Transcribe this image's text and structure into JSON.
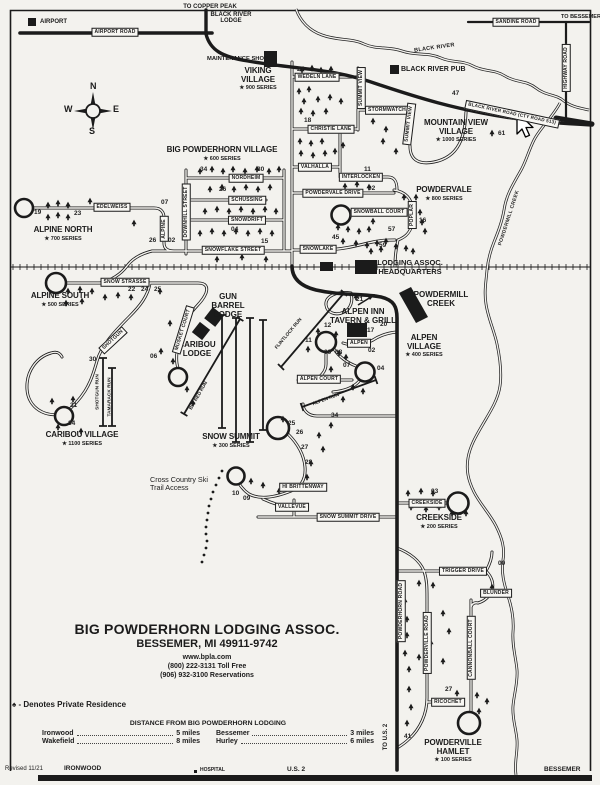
{
  "map": {
    "edges": {
      "to_copper_peak": "TO COPPER PEAK",
      "to_bessemer": "TO BESSEMER",
      "to_us2": "TO U.S. 2",
      "ironwood": "IRONWOOD",
      "hospital": "HOSPITAL",
      "us2": "U.S. 2",
      "bessemer": "BESSEMER",
      "revised": "Revised 11/21"
    },
    "compass": {
      "n": "N",
      "e": "E",
      "s": "S",
      "w": "W"
    },
    "waterways": {
      "black_river": "BLACK RIVER",
      "powdermill_creek": "POWDERMILL CREEK"
    },
    "pois": {
      "airport": "AIRPORT",
      "black_river_lodge": "BLACK RIVER LODGE",
      "maintenance_shop": "MAINTENANCE SHOP",
      "black_river_pub": "BLACK RIVER PUB",
      "lodging_hq": "LODGING ASSOC. HEADQUARTERS",
      "powdermill_creek": "POWDERMILL CREEK",
      "gun_barrel_lodge": "GUN BARREL LODGE",
      "caribou_lodge": "CARIBOU LODGE",
      "alpen_inn": "ALPEN INN TAVERN & GRILL",
      "xc_access": "Cross Country Ski Trail Access"
    },
    "villages": {
      "viking": {
        "name": "VIKING VILLAGE",
        "series": "★ 900 SERIES"
      },
      "mountain_view": {
        "name": "MOUNTAIN VIEW VILLAGE",
        "series": "★ 1000 SERIES"
      },
      "big_powderhorn": {
        "name": "BIG POWDERHORN VILLAGE",
        "series": "★ 600 SERIES"
      },
      "powdervale": {
        "name": "POWDERVALE",
        "series": "★ 800 SERIES"
      },
      "alpine_north": {
        "name": "ALPINE NORTH",
        "series": "★ 700 SERIES"
      },
      "alpine_south": {
        "name": "ALPINE SOUTH",
        "series": "★ 500 SERIES"
      },
      "alpen": {
        "name": "ALPEN VILLAGE",
        "series": "★ 400 SERIES"
      },
      "snow_summit": {
        "name": "SNOW SUMMIT",
        "series": "★ 300 SERIES"
      },
      "caribou": {
        "name": "CARIBOU VILLAGE",
        "series": "★ 1100 SERIES"
      },
      "creekside": {
        "name": "CREEKSIDE",
        "series": "★ 200 SERIES"
      },
      "powderville": {
        "name": "POWDERVILLE HAMLET",
        "series": "★ 100 SERIES"
      }
    },
    "roads": {
      "airport_road": "AIRPORT ROAD",
      "sandine_road": "SANDINE ROAD",
      "highway_road": "HIGHWAY ROAD",
      "black_river_road": "BLACK RIVER ROAD (CTY ROAD 513)",
      "wedeln_lane": "WEDELN LANE",
      "summit_view_a": "SUMMIT VIEW",
      "summit_view_b": "SUMMIT VIEW",
      "stormwatch": "STORMWATCH",
      "christie_lane": "CHRISTIE LANE",
      "valhalla": "VALHALLA",
      "interlocken": "INTERLOCKEN",
      "nordheim": "NORDHEIM",
      "schussing": "SCHUSSING",
      "snowdrift": "SNOWDRIFT",
      "snowflake_street": "SNOWFLAKE STREET",
      "downhill_street": "DOWNHILL STREET",
      "alpine": "ALPINE",
      "edelweiss": "EDELWEISS",
      "powdervale_drive": "POWDERVALE DRIVE",
      "snowball_court": "SNOWBALL COURT",
      "poplar": "POPLAR",
      "snowlake": "SNOWLAKE",
      "snow_strasse": "SNOW STRASSE",
      "musket_court": "MUSKET COURT",
      "shotgun": "SHOTGUN",
      "alpen": "ALPEN",
      "alpen_court": "ALPEN COURT",
      "hi_brittenway": "HI BRITTENWAY",
      "vallevue": "VALLEVUE",
      "snow_summit_drive": "SNOW SUMMIT DRIVE",
      "creekside": "CREEKSIDE",
      "trigger_drive": "TRIGGER DRIVE",
      "blunder": "BLUNDER",
      "ricochet": "RICOCHET",
      "powderhorn_road": "POWDERHORN ROAD",
      "powderville_road": "POWDERVILLE ROAD",
      "cannonball_court": "CANNONBALL COURT"
    },
    "runs": {
      "shotgun_run": "SHOTGUN RUN",
      "tamarack_run": "TAMARACK RUN",
      "big_red_run": "BIG RED RUN",
      "flintlock_run": "FLINTLOCK RUN",
      "alpen_run": "ALPEN RUN"
    },
    "lots": {
      "wedeln": "27",
      "christie": "18",
      "interlocken": "11",
      "powdervale_drive": "02",
      "highway": "47",
      "mountain_view": "61",
      "nordheim_w": "34",
      "nordheim_e": "30",
      "schussing": "26",
      "snowdrift": "04",
      "snowflake": "15",
      "alpine_curve": "07",
      "alpine_w": "26",
      "alpine_e": "02",
      "poplar": "16",
      "powdervale_a": "57",
      "powdervale_b": "45",
      "powdervale_c": "59",
      "alpine_north_w": "19",
      "alpine_north_e": "23",
      "snow_strasse_a": "22",
      "snow_strasse_b": "24",
      "snow_strasse_c": "25",
      "hq_ramp": "21",
      "shotgun": "30",
      "musket": "06",
      "caribou_a": "31",
      "caribou_b": "34",
      "alpen_a": "12",
      "alpen_b": "11",
      "alpen_c": "17",
      "alpen_d": "20",
      "alpen_e": "02",
      "alpen_f": "09",
      "alpen_g": "08",
      "alpen_h": "07",
      "alpen_i": "04",
      "road34": "34",
      "summit_a": "25",
      "summit_b": "26",
      "summit_c": "27",
      "summit_d": "28",
      "summit_e": "10",
      "summit_f": "09",
      "creekside": "03",
      "blunder": "00",
      "ricochet": "27",
      "powderville": "41"
    }
  },
  "footer": {
    "org": "BIG POWDERHORN LODGING ASSOC.",
    "address": "BESSEMER, MI 49911-9742",
    "web": "www.bpla.com",
    "phone1": "(800) 222-3131 Toll Free",
    "phone2": "(906) 932-3100 Reservations",
    "legend_symbol": "♠",
    "legend_text": "- Denotes Private Residence",
    "distance_title": "DISTANCE FROM BIG POWDERHORN LODGING",
    "distances": [
      {
        "place": "Ironwood",
        "miles": "5 miles"
      },
      {
        "place": "Bessemer",
        "miles": "3 miles"
      },
      {
        "place": "Wakefield",
        "miles": "8 miles"
      },
      {
        "place": "Hurley",
        "miles": "6 miles"
      }
    ]
  }
}
